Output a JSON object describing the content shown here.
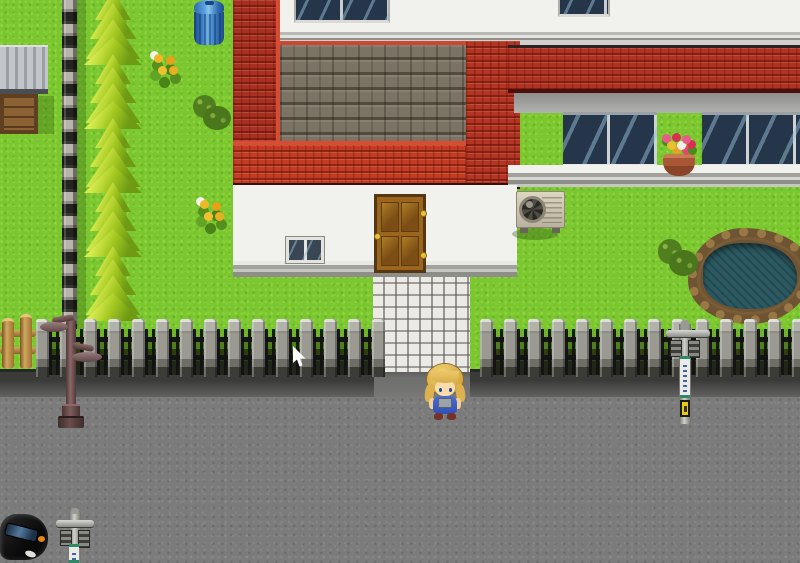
{
  "meta": {
    "scene": "rpg-town-street",
    "viewport_width": 800,
    "viewport_height": 563
  },
  "palette": {
    "grass": "#7ac72f",
    "road": "#7b7b7b",
    "wall": "#f1f1ee",
    "glass": "#26364a",
    "stone": "#7b7363",
    "stoneLip": "#cc4630",
    "roofLip": "#d84c34",
    "doorWood": "#9a661e",
    "doorFrame": "#553813",
    "gold": "#e8c23a",
    "treeLight": "#d8ec52",
    "treeMid": "#a6ca22",
    "treeDark": "#2e5a0c",
    "water": "#2c5a62",
    "pondRim": "#9a7846",
    "flowerYellow": "#f0b824",
    "flowerPink": "#e85a8a",
    "potClay": "#a85636",
    "bandWhite": "#eceae6",
    "signYellow": "#e8c818",
    "carBody": "#0a0a0a",
    "skin": "#f8dcab",
    "hair": "#d4a845",
    "overalls": "#4a6ad8",
    "cursorFill": "#ffffff"
  },
  "rects": {
    "grass": [
      0,
      0,
      800,
      563
    ],
    "road": [
      0,
      394,
      800,
      169
    ],
    "curb": [
      0,
      369,
      800,
      28
    ],
    "curbGap": [
      374,
      369,
      96,
      28
    ],
    "stoneStrip": [
      62,
      0,
      15,
      372
    ],
    "stoneStripShadow": [
      77,
      0,
      9,
      372
    ],
    "shedRoof": [
      0,
      45,
      48,
      49
    ],
    "shedCrate": [
      0,
      94,
      38,
      40
    ],
    "shedShadow": [
      38,
      96,
      16,
      38
    ],
    "trashBin": [
      194,
      0,
      30,
      45
    ],
    "flowers1": [
      146,
      50,
      38,
      36
    ],
    "flowers2": [
      192,
      196,
      42,
      40
    ],
    "bush1": [
      190,
      92,
      43,
      40
    ],
    "bush2": [
      655,
      236,
      45,
      42
    ],
    "pond": [
      688,
      228,
      124,
      96
    ],
    "upperWall": [
      273,
      0,
      527,
      34
    ],
    "wallTrim": [
      273,
      30,
      527,
      15
    ],
    "windowA": [
      294,
      0,
      96,
      23
    ],
    "windowB": [
      558,
      0,
      52,
      17
    ],
    "stoneRoof": [
      276,
      41,
      194,
      104
    ],
    "roofLeft": [
      233,
      0,
      47,
      145
    ],
    "roofBottom": [
      233,
      141,
      247,
      48
    ],
    "roofCorner": [
      466,
      41,
      54,
      148
    ],
    "awning": [
      508,
      45,
      292,
      48
    ],
    "awningShadow": [
      514,
      93,
      286,
      20
    ],
    "bigWindowLeft": [
      563,
      112,
      94,
      55
    ],
    "bigWindowRight": [
      702,
      112,
      98,
      55
    ],
    "windowSill": [
      508,
      165,
      292,
      22
    ],
    "flowerPot": [
      654,
      130,
      50,
      48
    ],
    "centralWall": [
      233,
      185,
      284,
      85
    ],
    "centralSill": [
      233,
      261,
      284,
      16
    ],
    "smallWindow": [
      286,
      237,
      38,
      26
    ],
    "door": [
      374,
      194,
      52,
      79
    ],
    "acShadow": [
      512,
      228,
      46,
      12
    ],
    "acUnit": [
      516,
      191,
      49,
      43
    ],
    "path": [
      373,
      272,
      97,
      100
    ],
    "woodFence": [
      0,
      314,
      38,
      56
    ],
    "ironFence": [
      0,
      319,
      800,
      58
    ],
    "lamp": [
      40,
      296,
      70,
      134
    ],
    "signPoleRight": [
      664,
      320,
      48,
      104
    ],
    "car": [
      0,
      508,
      50,
      55
    ],
    "signPoleCar": [
      54,
      508,
      42,
      55
    ],
    "character": [
      426,
      358,
      38,
      66
    ],
    "cursor": [
      292,
      346,
      16,
      24
    ]
  },
  "trees": {
    "x": 84,
    "w": 58,
    "h": 76,
    "startY": -10,
    "spacing": 64,
    "count": 5
  },
  "fence": {
    "unit": 24,
    "postWidth": 13,
    "sections": [
      [
        36,
        374
      ],
      [
        480,
        800
      ]
    ]
  }
}
